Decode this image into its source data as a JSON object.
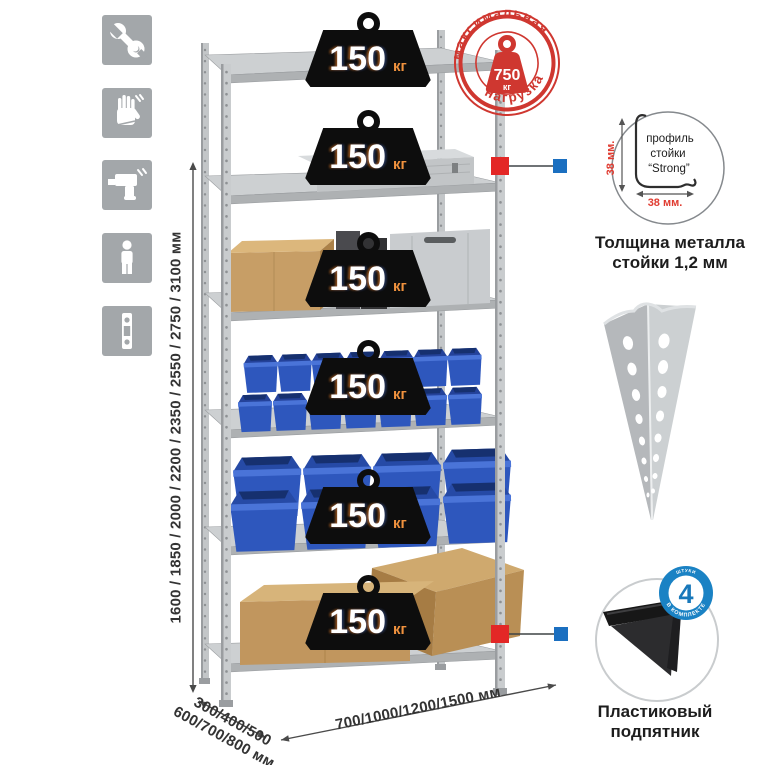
{
  "icons": [
    "wrench",
    "gloves",
    "drill",
    "person",
    "perforated-profile"
  ],
  "height_dimension": {
    "label": "1600 / 1850 / 2000 / 2200 / 2350 / 2550 / 2750 / 3100 мм"
  },
  "depth_dimension": {
    "line1": "300/400/500",
    "line2": "600/700/800 мм"
  },
  "width_dimension": {
    "label": "700/1000/1200/1500 мм"
  },
  "stamp": {
    "arc_top": "максимальная",
    "arc_bottom": "нагрузка",
    "weight_value": "750",
    "weight_unit": "кг"
  },
  "shelf_badges": [
    {
      "value": "150",
      "unit": "кг"
    },
    {
      "value": "150",
      "unit": "кг"
    },
    {
      "value": "150",
      "unit": "кг"
    },
    {
      "value": "150",
      "unit": "кг"
    },
    {
      "value": "150",
      "unit": "кг"
    },
    {
      "value": "150",
      "unit": "кг"
    }
  ],
  "profile_detail": {
    "dim_v": "38 мм.",
    "dim_h": "38 мм.",
    "label1": "профиль",
    "label2": "стойки",
    "label3": "“Strong”",
    "caption1": "Толщина металла",
    "caption2": "стойки 1,2 мм"
  },
  "foot_detail": {
    "count": "4",
    "count_top": "штуки",
    "count_arc": "в комплекте",
    "caption1": "Пластиковый",
    "caption2": "подпятник"
  },
  "colors": {
    "stamp_red": "#cf3730",
    "connector_red": "#e32726",
    "connector_blue": "#1b6fc0",
    "bin_blue": "#2e57bd",
    "metal_gray": "#c6c9cb",
    "badge_black": "#0d0d0d",
    "unit_orange": "#f0923e"
  }
}
